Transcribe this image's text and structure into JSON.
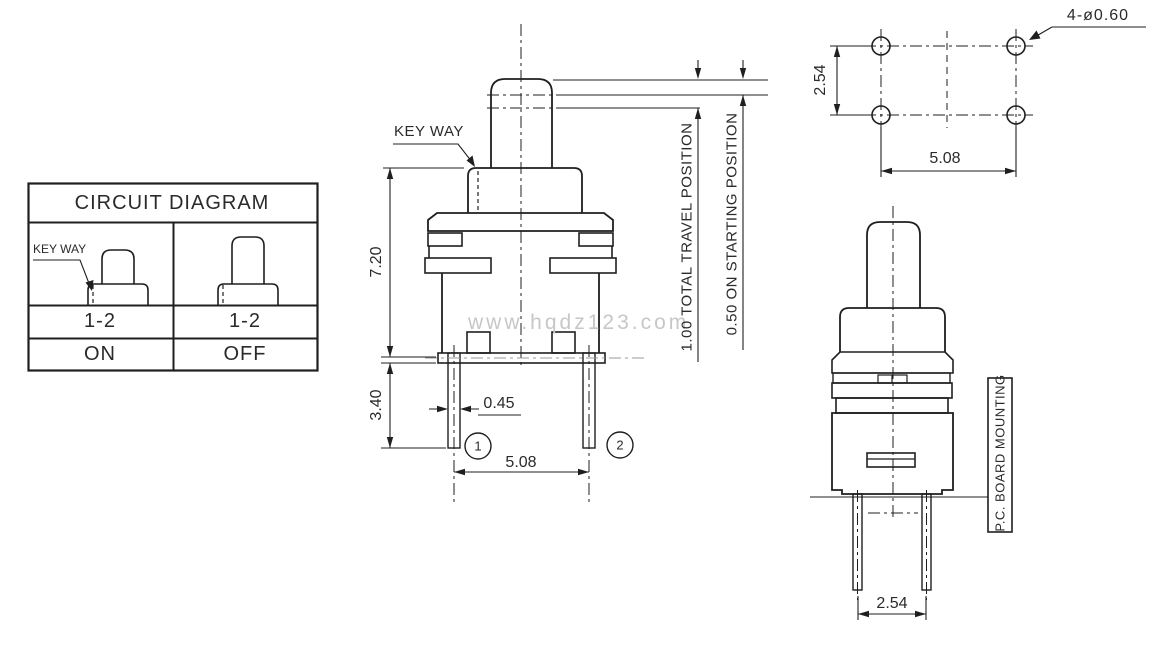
{
  "watermark": "www.hqdz123.com",
  "colors": {
    "line": "#1f1f1f",
    "watermark": "#c7c7c7",
    "background": "#ffffff"
  },
  "circuit_table": {
    "title": "CIRCUIT DIAGRAM",
    "key_way_label": "KEY WAY",
    "columns": [
      {
        "pins": "1-2",
        "state": "ON"
      },
      {
        "pins": "1-2",
        "state": "OFF"
      }
    ]
  },
  "front_view": {
    "key_way_label": "KEY WAY",
    "dim_body_height": "7.20",
    "dim_pin_length": "3.40",
    "dim_pin_width": "0.45",
    "dim_pin_pitch": "5.08",
    "pin1": "1",
    "pin2": "2",
    "total_travel": "1.00 TOTAL TRAVEL POSITION",
    "starting_position": "0.50 ON STARTING POSITION"
  },
  "hole_pattern": {
    "hole_label": "4-ø0.60",
    "dim_row_pitch": "2.54",
    "dim_col_pitch": "5.08"
  },
  "side_view": {
    "mounting_label": "P.C. BOARD MOUNTING",
    "dim_pin_pitch": "2.54"
  }
}
